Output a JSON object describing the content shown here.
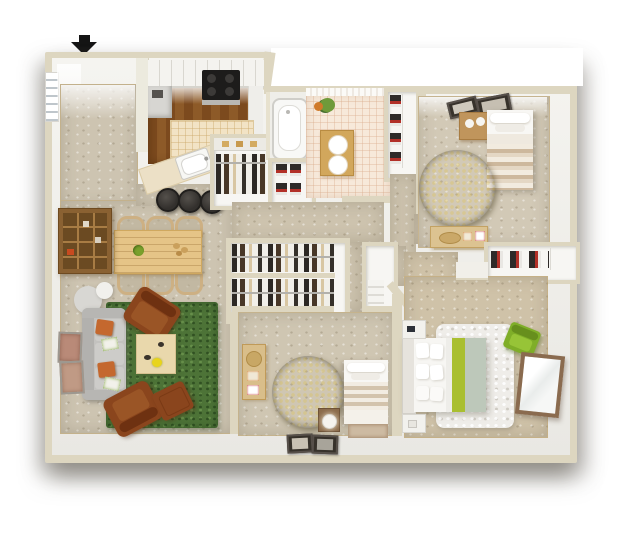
{
  "image_type": "3d-apartment-floorplan-render",
  "entry_arrow": {
    "direction": "down",
    "meaning": "main-entry",
    "color": "#151515"
  },
  "colors": {
    "wall_outer": "#ddd6c0",
    "wall_face": "#f3f2ee",
    "carpet_living": "#cdc4b1",
    "carpet_bedroom": "#d2c9b6",
    "carpet_bedroom2": "#cfc6b2",
    "carpet_master": "#cfc2a8",
    "carpet_hall": "#cdc3ae",
    "kitchen_wood_dark": "#7c4a1e",
    "kitchen_wood_light": "#8d5a28",
    "kitchen_tile": "#f2e3c5",
    "bath_tile": "#f7e9da",
    "vanity_wood": "#d2a75c",
    "rug_green": "#4d7337",
    "rug_olive": "#4a3d10",
    "rug_white": "#efede9",
    "sofa_gray": "#c3c2bf",
    "pillow_orange": "#c4682e",
    "leather_brown": "#8a451d",
    "table_wood": "#e5c487",
    "coffee_table": "#e9d8ac",
    "bookshelf_brown": "#8a6132",
    "stool_dark": "#33302d",
    "counter_cream": "#ece0c6",
    "bed_stripe_tan": "#cdb89d",
    "bed_lime": "#a9bf30",
    "bed_sage": "#bdc8ba",
    "chair_green": "#7fae28",
    "mirror_frame": "#8a6b4f",
    "dresser_tan": "#dcc391",
    "arrow_black": "#151515"
  },
  "rooms": [
    {
      "id": "entry",
      "name": "entry"
    },
    {
      "id": "living",
      "name": "living room"
    },
    {
      "id": "dining",
      "name": "dining area"
    },
    {
      "id": "kitchen",
      "name": "kitchen"
    },
    {
      "id": "bathroom",
      "name": "bathroom"
    },
    {
      "id": "hallway",
      "name": "hallway"
    },
    {
      "id": "bedroom1",
      "name": "bedroom 1 (top right)"
    },
    {
      "id": "bedroom2",
      "name": "bedroom 2 (bottom center)"
    },
    {
      "id": "master",
      "name": "master bedroom (bottom right)"
    },
    {
      "id": "closets",
      "name": "wardrobe / linen / shoe closets"
    }
  ],
  "furniture": [
    "entry arrow",
    "window with blinds",
    "bookshelf",
    "dining table",
    "six dining chairs",
    "bar counter with sink",
    "three bar stools",
    "range cooktop",
    "upper cabinets",
    "tiled kitchen island",
    "bathtub",
    "double-sink vanity",
    "potted plant",
    "hanging-clothes closets",
    "shoe closets",
    "linen closet",
    "gray sofa with orange pillows",
    "round side table",
    "green area rug",
    "coffee table",
    "two leather armchairs",
    "leather ottoman",
    "wall art frames",
    "bedroom1 bed",
    "bedroom1 nightstand",
    "bedroom1 dresser",
    "round olive rug x2",
    "bedroom2 bed with bench",
    "bedroom2 dresser",
    "nightstand with lamp",
    "floor picture frames",
    "master bed with lime stripe",
    "two white nightstands",
    "white shag rug",
    "green accent chair",
    "leaning mirror"
  ]
}
